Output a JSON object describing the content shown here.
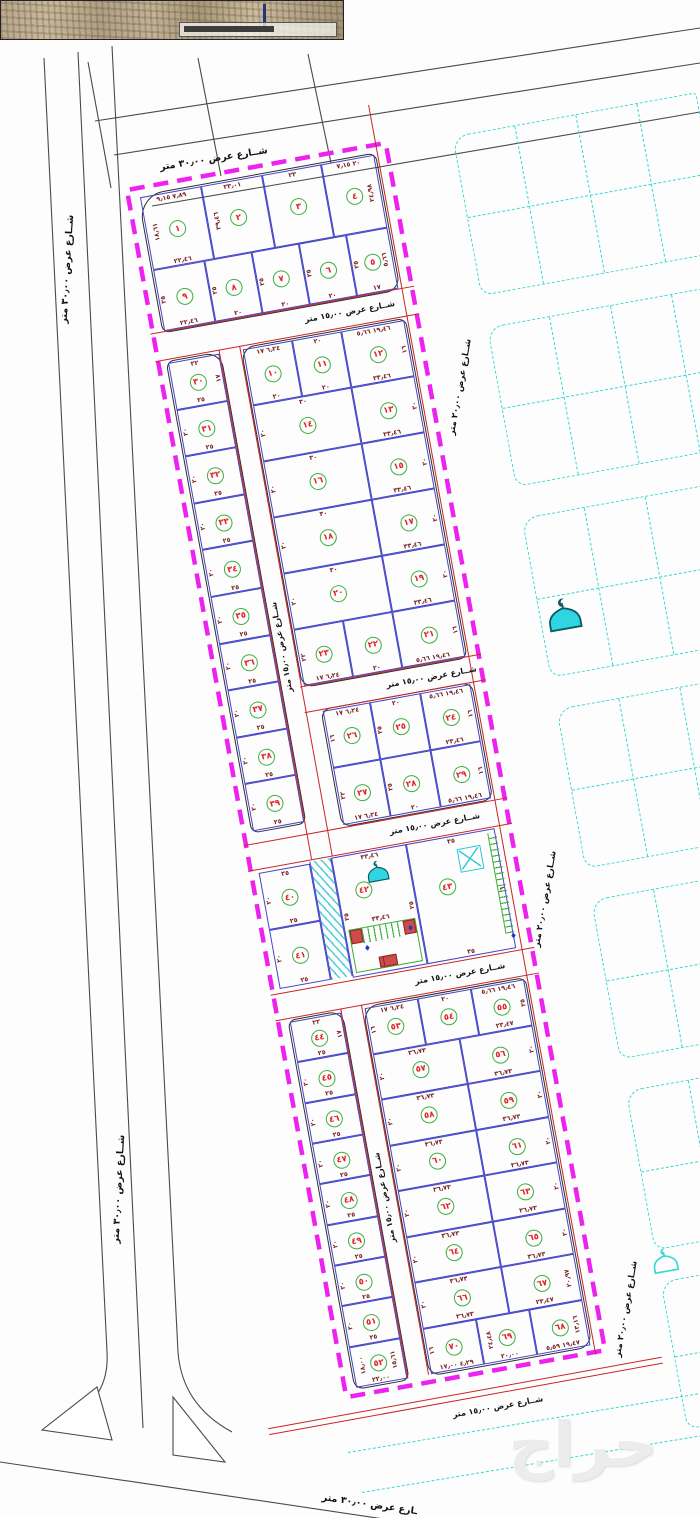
{
  "streets": {
    "w30": "شــارع عرض ٣٠٫٠٠ متر",
    "w30_partial": "ـارع عرض ٣٠٫٠٠ متر",
    "w20": "شــارع عرض ٢٠٫٠٠ متر",
    "w15": "شــارع عرض ١٥٫٠٠ متر"
  },
  "watermark": {
    "text": "حراج"
  },
  "icons": {
    "mosque": "mosque-dome-crescent-icon",
    "mosque_small": "mosque-outline-icon",
    "transformer": "x-box-marker",
    "diamond": "♦"
  },
  "colors": {
    "boundary": "#ee22ee",
    "plot_lines": "#4343c6",
    "street_red": "#cc2323",
    "cyan": "#35d8d2",
    "circle_green": "#3fae3f",
    "number_red": "#e02525",
    "dims": "#7a2424",
    "roads": "#4a4a4a"
  },
  "blocks": {
    "a": {
      "rows": [
        [
          {
            "n": "١",
            "d": {
              "t": "٧٫٨٩ ٩٫١٥",
              "l": "١٨٫٦١",
              "b": "٢٢٫٤٦"
            }
          },
          {
            "n": "٢",
            "d": {
              "t": "٢٣٫٠١",
              "l": "٣٩٫٤٦"
            }
          },
          {
            "n": "٣",
            "d": {
              "t": "٢٣"
            }
          },
          {
            "n": "٤",
            "d": {
              "t": "٢٠ ٧٫١٥",
              "r": "٢٤٫٩٨"
            }
          }
        ],
        [
          {
            "n": "٩",
            "d": {
              "l": "٢٥",
              "b": "٢٢٫٤٦"
            }
          },
          {
            "n": "٨",
            "d": {
              "l": "٢٥",
              "b": "٢٠"
            }
          },
          {
            "n": "٧",
            "d": {
              "l": "٢٥",
              "b": "٢٠"
            }
          },
          {
            "n": "٦",
            "d": {
              "l": "٢٥",
              "b": "٢٠"
            }
          },
          {
            "n": "٥",
            "d": {
              "l": "٢٥",
              "b": "١٧",
              "r": "٥٫٦٦"
            }
          }
        ]
      ]
    },
    "left_column": {
      "plots": [
        {
          "n": "٣٠",
          "d": {
            "t": "٢٢",
            "r": "١٧",
            "b": "٢٥"
          }
        },
        {
          "n": "٣١",
          "d": {
            "l": "٢٠",
            "b": "٢٥"
          }
        },
        {
          "n": "٣٢",
          "d": {
            "l": "٢٠",
            "b": "٢٥"
          }
        },
        {
          "n": "٣٣",
          "d": {
            "l": "٢٠",
            "b": "٢٥"
          }
        },
        {
          "n": "٣٤",
          "d": {
            "l": "٢٠",
            "b": "٢٥"
          }
        },
        {
          "n": "٣٥",
          "d": {
            "l": "٢٠",
            "b": "٢٥"
          }
        },
        {
          "n": "٣٦",
          "d": {
            "l": "٢٠",
            "b": "٢٥"
          }
        },
        {
          "n": "٣٧",
          "d": {
            "l": "٢٠",
            "b": "٢٥"
          }
        },
        {
          "n": "٣٨",
          "d": {
            "l": "٢٠",
            "b": "٢٥"
          }
        },
        {
          "n": "٣٩",
          "d": {
            "l": "٢٠",
            "b": "٢٥"
          }
        }
      ]
    },
    "center": {
      "rows": [
        [
          {
            "n": "١٠",
            "d": {
              "t": "٦٫٢٤ ١٧",
              "b": "٢٠"
            }
          },
          {
            "n": "١١",
            "d": {
              "t": "٢٠",
              "b": "٢٠"
            }
          },
          {
            "n": "١٢",
            "d": {
              "t": "١٩٫٤٦ ٥٫٦٦",
              "r": "١٦",
              "b": "٣٣٫٤٦"
            }
          }
        ],
        [
          {
            "n": "١٤",
            "d": {
              "t": "٣٠",
              "l": "٢٠"
            }
          },
          {
            "n": "١٣",
            "d": {
              "r": "٢٠",
              "b": "٣٣٫٤٦"
            }
          }
        ],
        [
          {
            "n": "١٦",
            "d": {
              "t": "٣٠",
              "l": "٢٠"
            }
          },
          {
            "n": "١٥",
            "d": {
              "r": "٢٠",
              "b": "٣٣٫٤٦"
            }
          }
        ],
        [
          {
            "n": "١٨",
            "d": {
              "t": "٣٠",
              "l": "٢٠"
            }
          },
          {
            "n": "١٧",
            "d": {
              "r": "٢٠",
              "b": "٣٣٫٤٦"
            }
          }
        ],
        [
          {
            "n": "٢٠",
            "d": {
              "t": "٣٠",
              "l": "٢٠"
            }
          },
          {
            "n": "١٩",
            "d": {
              "r": "٢٠",
              "b": "٣٣٫٤٦"
            }
          }
        ],
        [
          {
            "n": "٢٣",
            "d": {
              "l": "٢٢",
              "b": "٦٫٢٤ ١٧"
            }
          },
          {
            "n": "٢٢",
            "d": {
              "b": "٢٠"
            }
          },
          {
            "n": "٢١",
            "d": {
              "r": "١٦",
              "b": "١٩٫٤٦ ٥٫٦٦"
            }
          }
        ]
      ]
    },
    "mid": {
      "rows": [
        [
          {
            "n": "٢٦",
            "d": {
              "t": "٦٫٢٤ ١٧",
              "l": "١٦"
            }
          },
          {
            "n": "٢٥",
            "d": {
              "t": "٢٠",
              "l": "٢٥"
            }
          },
          {
            "n": "٢٤",
            "d": {
              "t": "١٩٫٤٦ ٥٫٦٦",
              "r": "١٦",
              "b": "٢٣٫٤٦"
            }
          }
        ],
        [
          {
            "n": "٢٧",
            "d": {
              "l": "٢٢",
              "b": "٦٫٢٤ ١٧"
            }
          },
          {
            "n": "٢٨",
            "d": {
              "l": "٢٥",
              "b": "٢٠"
            }
          },
          {
            "n": "٢٩",
            "d": {
              "r": "١٦",
              "b": "١٩٫٤٦ ٥٫٦٦"
            }
          }
        ]
      ]
    },
    "special": {
      "plots": [
        {
          "n": "٤٠",
          "d": {
            "t": "٢٥",
            "l": "٢٠",
            "b": "٢٥"
          }
        },
        {
          "n": "٤١",
          "d": {
            "l": "٢٠",
            "b": "٢٥"
          }
        },
        {
          "n": "٤٢",
          "d": {
            "t": "٣٣٫٤٦",
            "l": "٢٥",
            "r": "٢٥",
            "m": "٣٣٫٤٦"
          }
        },
        {
          "n": "٤٣",
          "d": {
            "t": "٣٥",
            "r": "٦",
            "b": "٣٥"
          }
        }
      ]
    },
    "lower_left": {
      "plots": [
        {
          "n": "٤٤",
          "d": {
            "t": "٢٢",
            "r": "١٧",
            "b": "٢٥"
          }
        },
        {
          "n": "٤٥",
          "d": {
            "l": "٢٠",
            "b": "٢٥"
          }
        },
        {
          "n": "٤٦",
          "d": {
            "l": "٢٠",
            "b": "٢٥"
          }
        },
        {
          "n": "٤٧",
          "d": {
            "l": "٢٠",
            "b": "٢٥"
          }
        },
        {
          "n": "٤٨",
          "d": {
            "l": "٢٠",
            "b": "٢٥"
          }
        },
        {
          "n": "٤٩",
          "d": {
            "l": "٢٠",
            "b": "٢٥"
          }
        },
        {
          "n": "٥٠",
          "d": {
            "l": "٢٠",
            "b": "٢٥"
          }
        },
        {
          "n": "٥١",
          "d": {
            "l": "٢٠",
            "b": "٢٥"
          }
        },
        {
          "n": "٥٢",
          "d": {
            "l": "١٨٫٠٠",
            "r": "١٥٫٦١",
            "b": "٢٢٫٠٠"
          }
        }
      ]
    },
    "lower": {
      "rows": [
        [
          {
            "n": "٥٣",
            "d": {
              "t": "٦٫٢٤ ١٧",
              "l": "١٦"
            }
          },
          {
            "n": "٥٤",
            "d": {
              "t": "٢٠"
            }
          },
          {
            "n": "٥٥",
            "d": {
              "t": "١٩٫٤٦ ٥٫٦٦",
              "r": "٢٥",
              "b": "٢٣٫٤٧"
            }
          }
        ],
        [
          {
            "n": "٥٧",
            "d": {
              "t": "٣٦٫٧٣",
              "l": "٢٠"
            }
          },
          {
            "n": "٥٦",
            "d": {
              "r": "٢٠",
              "b": "٣٦٫٧٣"
            }
          }
        ],
        [
          {
            "n": "٥٨",
            "d": {
              "t": "٣٦٫٧٣",
              "l": "٢٠"
            }
          },
          {
            "n": "٥٩",
            "d": {
              "r": "٢٠",
              "b": "٣٦٫٧٣"
            }
          }
        ],
        [
          {
            "n": "٦٠",
            "d": {
              "t": "٣٦٫٧٣",
              "l": "٢٠"
            }
          },
          {
            "n": "٦١",
            "d": {
              "r": "٢٠",
              "b": "٣٦٫٧٣"
            }
          }
        ],
        [
          {
            "n": "٦٢",
            "d": {
              "t": "٣٦٫٧٣",
              "l": "٢٠"
            }
          },
          {
            "n": "٦٣",
            "d": {
              "r": "٢٠",
              "b": "٣٦٫٧٣"
            }
          }
        ],
        [
          {
            "n": "٦٤",
            "d": {
              "t": "٣٦٫٧٣",
              "l": "٢٠"
            }
          },
          {
            "n": "٦٥",
            "d": {
              "r": "٢٠",
              "b": "٣٦٫٧٣"
            }
          }
        ],
        [
          {
            "n": "٦٦",
            "d": {
              "t": "٣٦٫٧٣",
              "l": "٢٠",
              "b": "٣٦٫٧٣"
            }
          },
          {
            "n": "٦٧",
            "d": {
              "r": "٢٠٫٩٧",
              "b": "٢٣٫٤٧"
            }
          }
        ],
        [
          {
            "n": "٧٠",
            "d": {
              "l": "١٦",
              "b": "٤٫٢٩ ١٧٫٠٠"
            }
          },
          {
            "n": "٦٩",
            "d": {
              "l": "٢٤٫٤٨",
              "b": "٢٠٫٠٠"
            }
          },
          {
            "n": "٦٨",
            "d": {
              "r": "١٣٫١٦",
              "b": "١٩٫٤٧ ٥٫٥٩"
            }
          }
        ]
      ]
    }
  }
}
